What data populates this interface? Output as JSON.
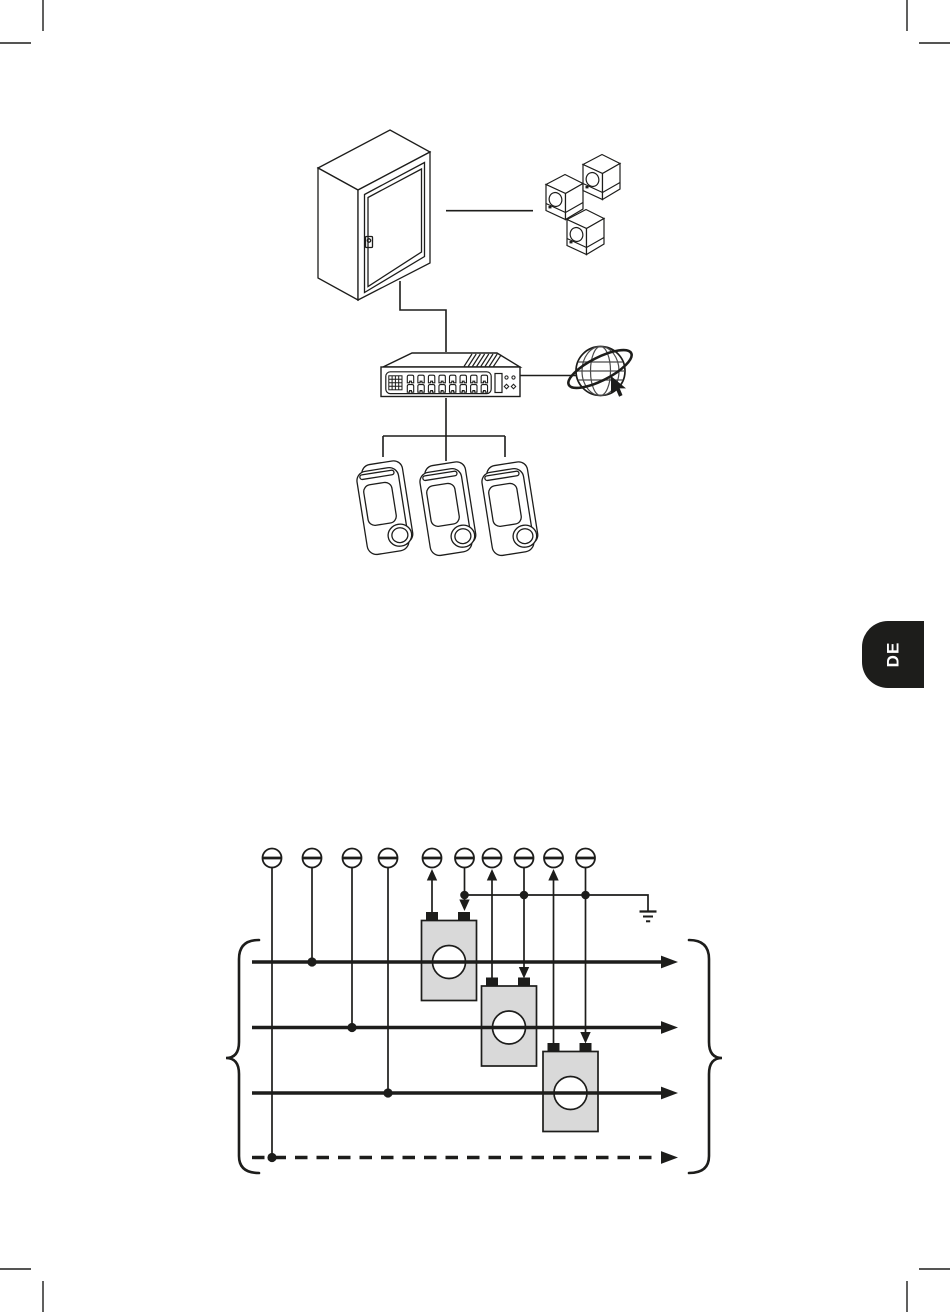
{
  "page": {
    "language_tab": "DE"
  },
  "colors": {
    "line": "#1d1d1b",
    "ct_fill": "#d9d9d9",
    "tab_bg": "#1d1d1b",
    "tab_text": "#ffffff",
    "page_bg": "#ffffff"
  },
  "network_diagram": {
    "cabinet_icon": "distribution-cabinet-icon",
    "meter_icons": {
      "name": "energy-meter-cube-icon",
      "count": 3
    },
    "switch_icon": {
      "name": "network-switch-icon",
      "ports": 16
    },
    "internet_icon": "internet-globe-icon",
    "cursor_icon": "mouse-cursor-icon",
    "wallbox_icons": {
      "name": "charging-wallbox-icon",
      "count": 3
    }
  },
  "wiring_diagram": {
    "terminal_icons": {
      "name": "screw-terminal-icon",
      "count": 10
    },
    "current_transformer_icons": {
      "name": "current-transformer-icon",
      "count": 3
    },
    "ground_icon": "earth-ground-icon",
    "solid_conductor_count": 3,
    "dashed_conductor_count": 1,
    "junction_dot_count": 7,
    "brace_icons": {
      "name": "curly-brace",
      "count": 2
    }
  },
  "print_marks": {
    "name": "crop-mark",
    "corner_count": 4
  }
}
